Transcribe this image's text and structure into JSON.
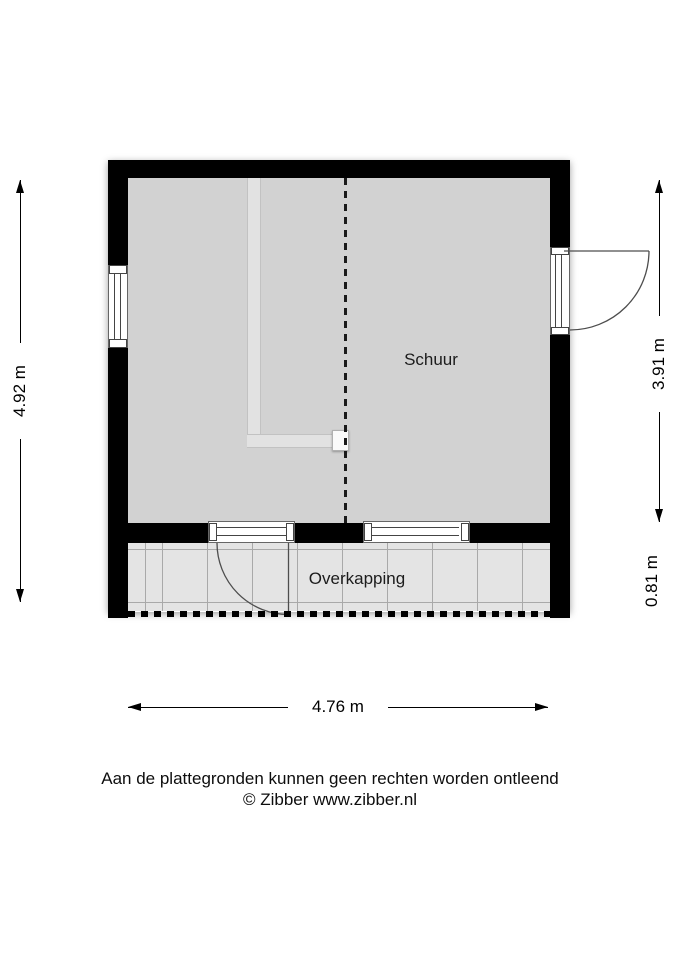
{
  "plan": {
    "room_labels": {
      "schuur": "Schuur",
      "overkapping": "Overkapping"
    },
    "dimensions": {
      "height_total": "4.92 m",
      "height_schuur": "3.91 m",
      "height_overkapping": "0.81 m",
      "width_total": "4.76 m"
    },
    "colors": {
      "wall": "#000000",
      "schuur_floor": "#d2d2d2",
      "overkapping_floor": "#e4e4e4",
      "floor_grid_line": "#a9a9a9",
      "opening_outline": "#666666",
      "door_swing": "#4d4d4d",
      "flue": "#e2e2e2"
    }
  },
  "footer": {
    "disclaimer": "Aan de plattegronden kunnen geen rechten worden ontleend",
    "copyright": "© Zibber www.zibber.nl"
  }
}
